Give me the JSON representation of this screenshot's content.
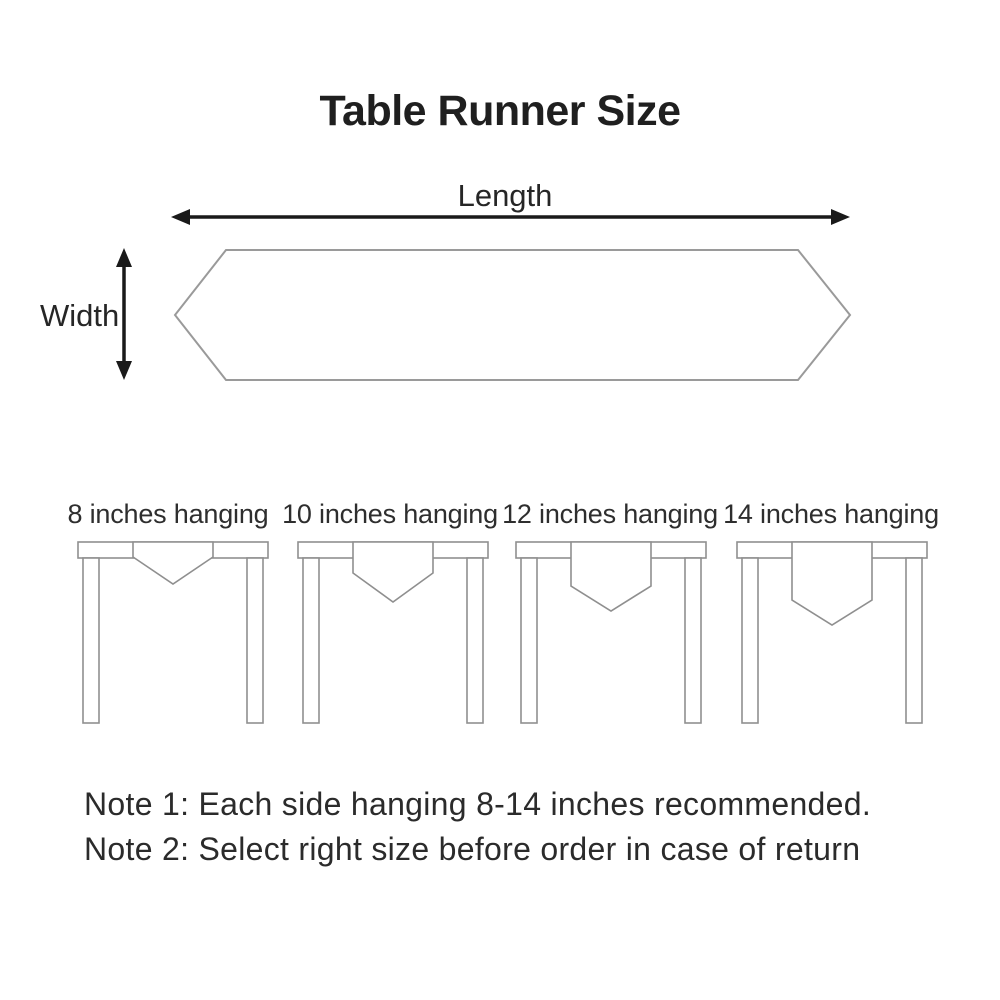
{
  "title": "Table Runner Size",
  "runner": {
    "length_label": "Length",
    "width_label": "Width"
  },
  "tables": [
    {
      "label": "8 inches hanging"
    },
    {
      "label": "10 inches hanging"
    },
    {
      "label": "12 inches hanging"
    },
    {
      "label": "14 inches hanging"
    }
  ],
  "notes": [
    "Note 1: Each side hanging 8-14 inches recommended.",
    "Note 2: Select right size before order in case of return"
  ],
  "colors": {
    "background": "#ffffff",
    "text": "#262626",
    "title_text": "#1f1f1f",
    "arrow_black": "#1a1a1a",
    "runner_outline_gray": "#9a9a9a",
    "table_outline_gray": "#8f8f8f"
  }
}
